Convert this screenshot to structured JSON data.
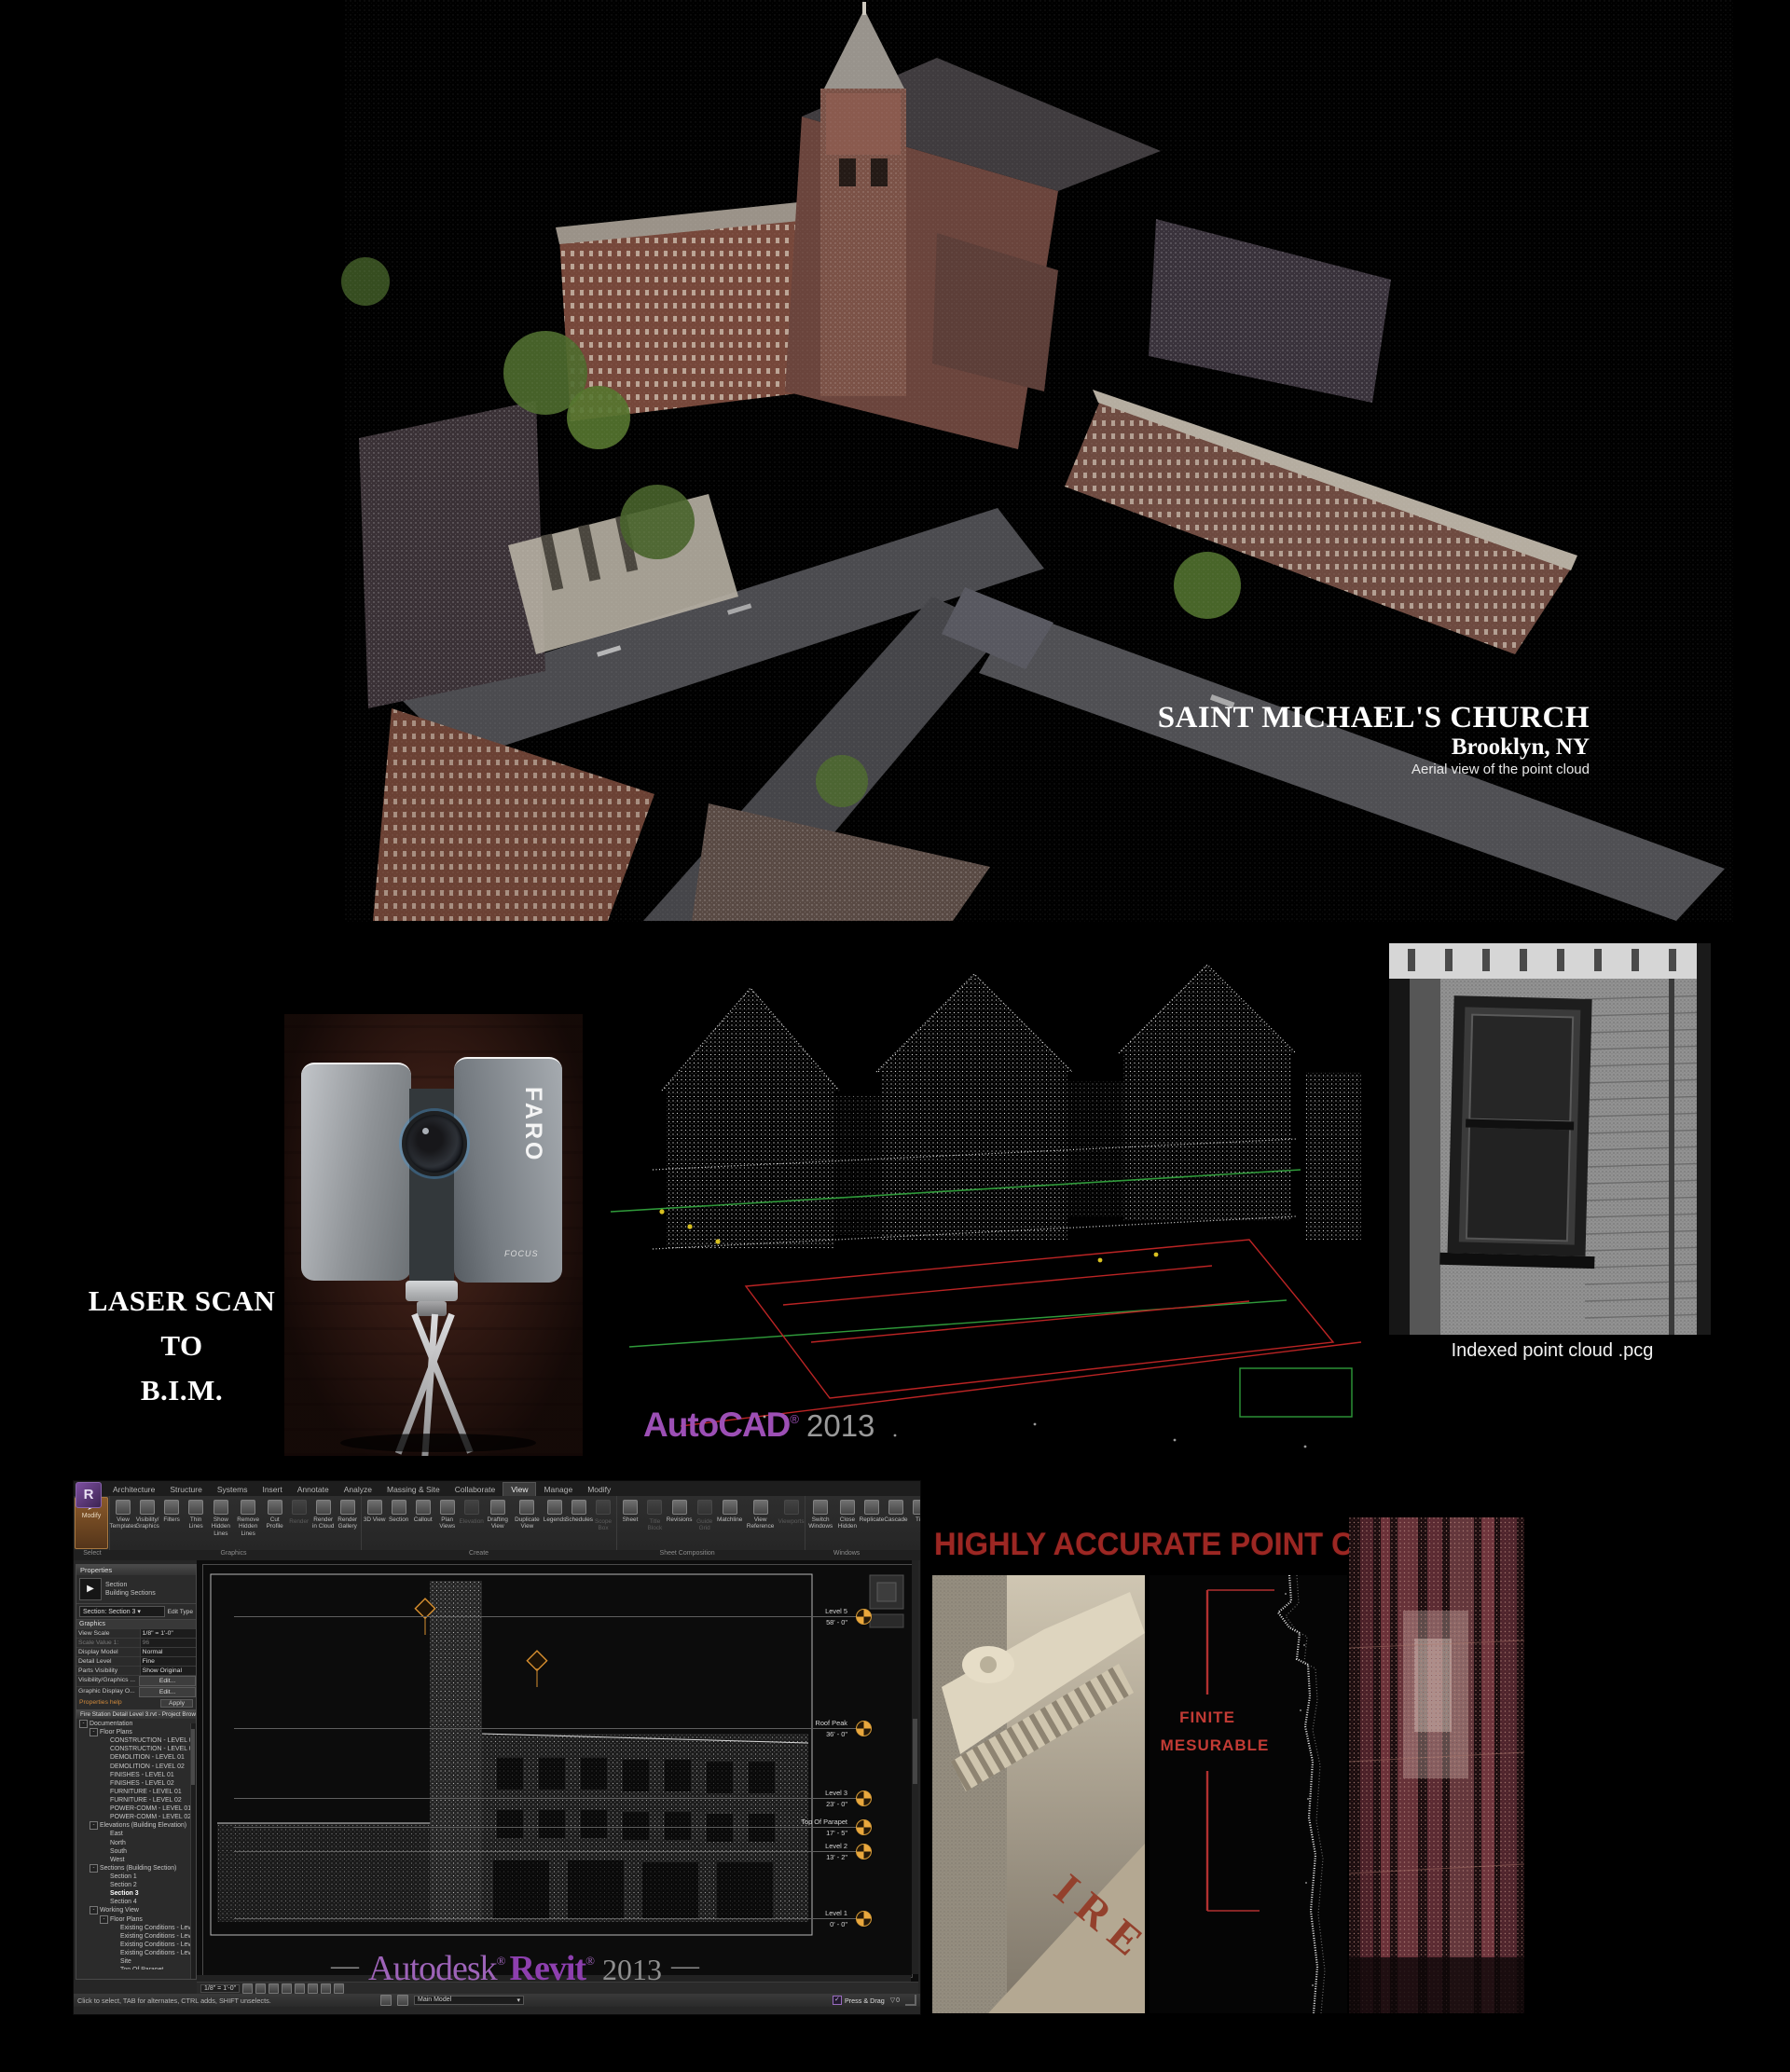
{
  "hero": {
    "title": "SAINT MICHAEL'S CHURCH",
    "subtitle": "Brooklyn, NY",
    "caption": "Aerial view of the point cloud"
  },
  "mid": {
    "heading_line1": "LASER SCAN",
    "heading_line2": "TO",
    "heading_line3": "B.I.M.",
    "scanner": {
      "brand": "FARO",
      "model": "FOCUS"
    },
    "autocad": {
      "brand": "AutoCAD",
      "reg": "®",
      "year": "2013"
    },
    "indexed_caption": "Indexed point cloud .pcg"
  },
  "revit": {
    "app_initial": "R",
    "tabs": [
      {
        "t": "Architecture"
      },
      {
        "t": "Structure"
      },
      {
        "t": "Systems"
      },
      {
        "t": "Insert"
      },
      {
        "t": "Annotate"
      },
      {
        "t": "Analyze"
      },
      {
        "t": "Massing & Site"
      },
      {
        "t": "Collaborate"
      },
      {
        "t": "View",
        "active": true
      },
      {
        "t": "Manage"
      },
      {
        "t": "Modify"
      }
    ],
    "modify_label": "Modify",
    "ribbon": {
      "groups": [
        {
          "label": "Select",
          "buttons": []
        },
        {
          "label": "Graphics",
          "buttons": [
            "View Templates",
            "Visibility/ Graphics",
            "Filters",
            "Thin Lines",
            "Show Hidden Lines",
            "Remove Hidden Lines",
            "Cut Profile",
            {
              "t": "Render",
              "dim": true
            },
            "Render in Cloud",
            "Render Gallery"
          ]
        },
        {
          "label": "Create",
          "buttons": [
            "3D View",
            "Section",
            "Callout",
            "Plan Views",
            {
              "t": "Elevation",
              "dim": true
            },
            "Drafting View",
            "Duplicate View",
            "Legends",
            "Schedules",
            {
              "t": "Scope Box",
              "dim": true
            }
          ]
        },
        {
          "label": "Sheet Composition",
          "buttons": [
            "Sheet",
            {
              "t": "Title Block",
              "dim": true
            },
            "Revisions",
            {
              "t": "Guide Grid",
              "dim": true
            },
            "Matchline",
            "View Reference",
            {
              "t": "Viewports",
              "dim": true
            }
          ]
        },
        {
          "label": "Windows",
          "buttons": [
            "Switch Windows",
            "Close Hidden",
            "Replicate",
            "Cascade",
            "Tile",
            "User Interface"
          ]
        }
      ]
    },
    "properties": {
      "title": "Properties",
      "type_name": "Section",
      "type_family": "Building Sections",
      "selector": "Section: Section 3",
      "edit_type": "Edit Type",
      "group": "Graphics",
      "rows": [
        {
          "label": "View Scale",
          "value": "1/8\" = 1'-0\""
        },
        {
          "label": "Scale Value 1:",
          "value": "96",
          "dim": true
        },
        {
          "label": "Display Model",
          "value": "Normal"
        },
        {
          "label": "Detail Level",
          "value": "Fine"
        },
        {
          "label": "Parts Visibility",
          "value": "Show Original"
        },
        {
          "label": "Visibility/Graphics ...",
          "value": "Edit...",
          "btn": true
        },
        {
          "label": "Graphic Display O...",
          "value": "Edit...",
          "btn": true
        }
      ],
      "help": "Properties help",
      "apply": "Apply"
    },
    "browser": {
      "title": "Fire Station Detail Level 3.rvt - Project Browser",
      "items": [
        {
          "t": "Documentation",
          "d": 0,
          "e": "-"
        },
        {
          "t": "Floor Plans",
          "d": 1,
          "e": "-"
        },
        {
          "t": "CONSTRUCTION - LEVEL 01",
          "d": 2
        },
        {
          "t": "CONSTRUCTION - LEVEL 02",
          "d": 2
        },
        {
          "t": "DEMOLITION - LEVEL 01",
          "d": 2
        },
        {
          "t": "DEMOLITION - LEVEL 02",
          "d": 2
        },
        {
          "t": "FINISHES - LEVEL 01",
          "d": 2
        },
        {
          "t": "FINISHES - LEVEL 02",
          "d": 2
        },
        {
          "t": "FURNITURE - LEVEL 01",
          "d": 2
        },
        {
          "t": "FURNITURE - LEVEL 02",
          "d": 2
        },
        {
          "t": "POWER-COMM - LEVEL 01",
          "d": 2
        },
        {
          "t": "POWER-COMM - LEVEL 02",
          "d": 2
        },
        {
          "t": "Elevations (Building Elevation)",
          "d": 1,
          "e": "-"
        },
        {
          "t": "East",
          "d": 2
        },
        {
          "t": "North",
          "d": 2
        },
        {
          "t": "South",
          "d": 2
        },
        {
          "t": "West",
          "d": 2
        },
        {
          "t": "Sections (Building Section)",
          "d": 1,
          "e": "-"
        },
        {
          "t": "Section 1",
          "d": 2
        },
        {
          "t": "Section 2",
          "d": 2
        },
        {
          "t": "Section 3",
          "d": 2,
          "bold": true
        },
        {
          "t": "Section 4",
          "d": 2
        },
        {
          "t": "Working View",
          "d": 1,
          "e": "-"
        },
        {
          "t": "Floor Plans",
          "d": 2,
          "e": "-"
        },
        {
          "t": "Existing Conditions - Level 1",
          "d": 3
        },
        {
          "t": "Existing Conditions - Level 2",
          "d": 3
        },
        {
          "t": "Existing Conditions - Level 3",
          "d": 3
        },
        {
          "t": "Existing Conditions - Level 5",
          "d": 3
        },
        {
          "t": "Site",
          "d": 3
        },
        {
          "t": "Top Of Parapet",
          "d": 3
        },
        {
          "t": "Ceiling Plans",
          "d": 2,
          "e": "+"
        },
        {
          "t": "3D Views",
          "d": 2,
          "e": "+"
        },
        {
          "t": "Legends",
          "d": 0,
          "e": "+"
        },
        {
          "t": "Schedules/Quantities",
          "d": 0,
          "e": "+"
        }
      ]
    },
    "canvas": {
      "levels": [
        {
          "name": "Level 5",
          "elev": "58' - 0\""
        },
        {
          "name": "Roof Peak",
          "elev": "36' - 0\""
        },
        {
          "name": "Level 3",
          "elev": "23' - 0\""
        },
        {
          "name": "Top Of Parapet",
          "elev": "17' - 5\""
        },
        {
          "name": "Level 2",
          "elev": "13' - 2\""
        },
        {
          "name": "Level 1",
          "elev": "0' - 0\""
        }
      ]
    },
    "view_bar": {
      "scale": "1/8\" = 1'-0\""
    },
    "status": {
      "hint": "Click to select, TAB for alternates, CTRL adds, SHIFT unselects.",
      "main_model": "Main Model",
      "press_drag": "Press & Drag",
      "filter_count": "0"
    },
    "brand": {
      "autodesk": "Autodesk",
      "revit": "Revit",
      "year": "2013",
      "reg": "®",
      "dash": "—"
    }
  },
  "accurate": {
    "heading": "HIGHLY ACCURATE POINT CLOUDS",
    "finite_line1": "FINITE",
    "finite_line2": "MESURABLE",
    "wall_letters": "IRE"
  }
}
